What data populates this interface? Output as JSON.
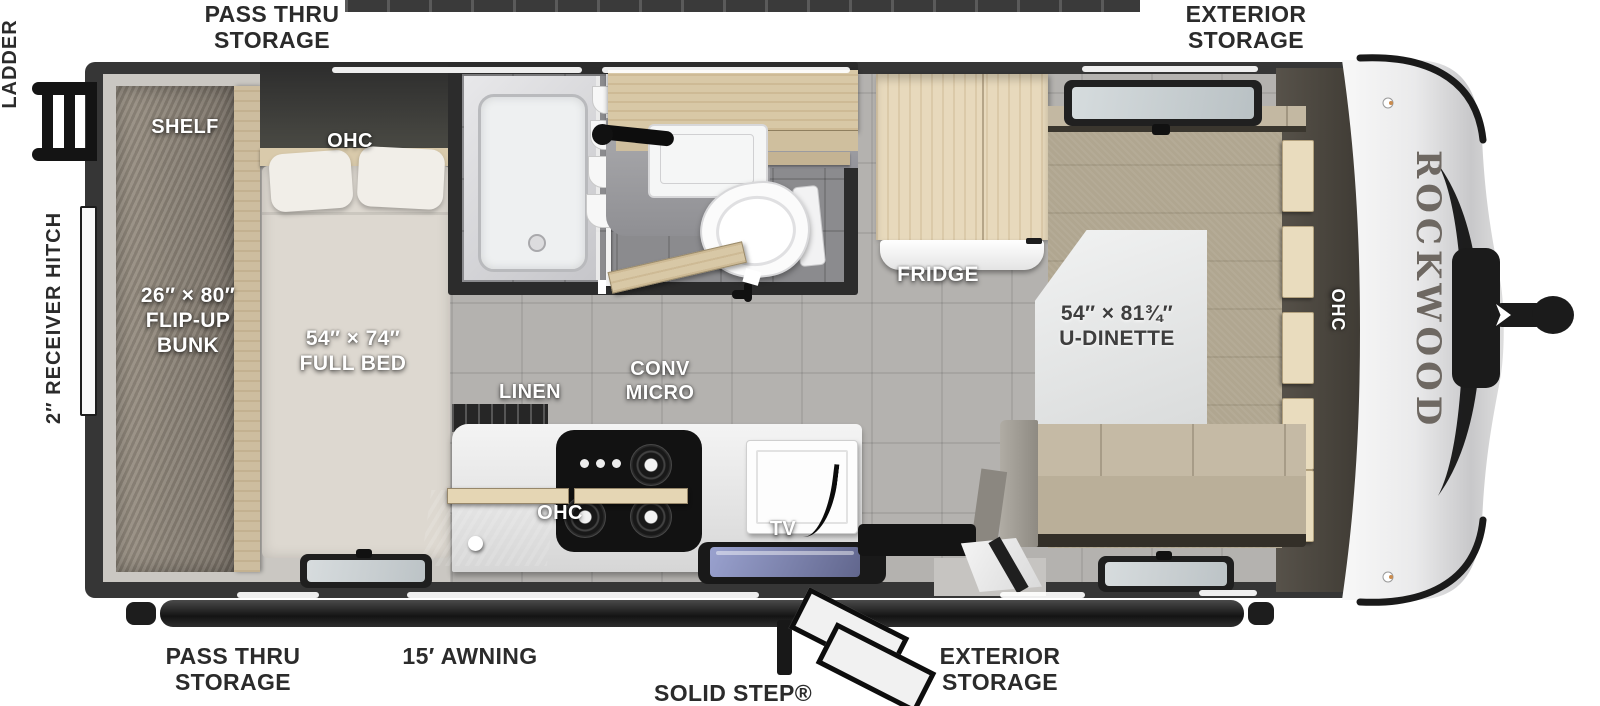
{
  "labels": {
    "top_left": "PASS THRU\nSTORAGE",
    "top_right": "EXTERIOR\nSTORAGE",
    "bottom_left": "PASS THRU\nSTORAGE",
    "awning": "15′ AWNING",
    "entry": "SOLID STEP® ENTRY",
    "bottom_right": "EXTERIOR\nSTORAGE",
    "ladder": "LADDER",
    "receiver": "2″ RECEIVER HITCH"
  },
  "interior": {
    "shelf": "SHELF",
    "bunk": "26″ × 80″\nFLIP-UP\nBUNK",
    "bed_ohc": "OHC",
    "bed": "54″ × 74″\nFULL BED",
    "linen": "LINEN",
    "conv_micro": "CONV\nMICRO",
    "kitchen_ohc": "OHC",
    "tv": "TV",
    "fridge": "FRIDGE",
    "dinette": "54″ × 81¾″\nU-DINETTE",
    "right_ohc": "OHC"
  },
  "brand": {
    "name": "ROCKWOOD",
    "sub": "GEO PRO"
  },
  "colors": {
    "wall": "#363636",
    "floor_tile": "#b4b2af",
    "bedroom_floor": "#cac7c2",
    "carpet": "#b0a690",
    "wood": "#e7d9bc",
    "label_dark": "#2b2b2b",
    "sink_glass": "#8a91c2"
  }
}
